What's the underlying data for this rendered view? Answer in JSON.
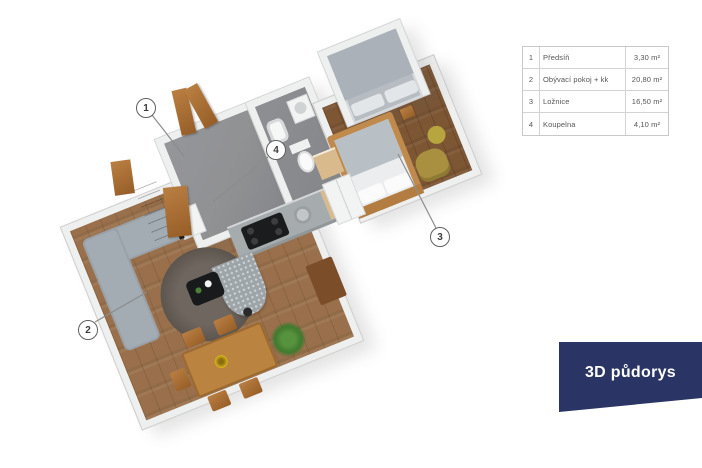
{
  "legend": {
    "rows": [
      {
        "num": "1",
        "name": "Předsíň",
        "area": "3,30 m²"
      },
      {
        "num": "2",
        "name": "Obývací pokoj + kk",
        "area": "20,80 m²"
      },
      {
        "num": "3",
        "name": "Ložnice",
        "area": "16,50 m²"
      },
      {
        "num": "4",
        "name": "Koupelna",
        "area": "4,10 m²"
      }
    ]
  },
  "banner": {
    "label": "3D půdorys"
  },
  "callouts": [
    {
      "label": "1"
    },
    {
      "label": "2"
    },
    {
      "label": "3"
    },
    {
      "label": "4"
    }
  ],
  "colors": {
    "banner_bg": "#2a3565",
    "floor_living": "#99704b",
    "floor_bedroom": "#7d5634",
    "floor_hall": "#909193",
    "wall": "#eef0f0",
    "leader_line": "#8c8c8c"
  }
}
